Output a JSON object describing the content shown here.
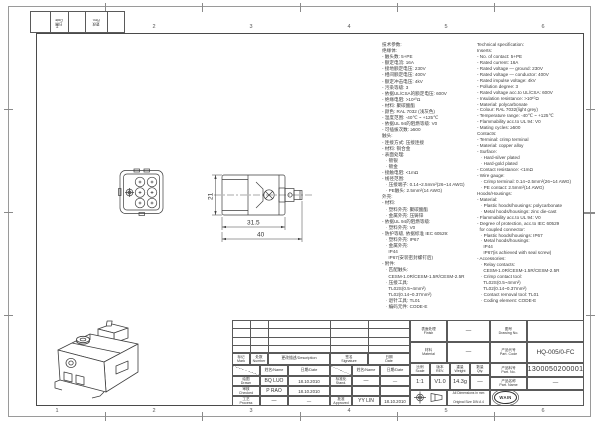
{
  "frame": {
    "zones": [
      "1",
      "2",
      "3",
      "4",
      "5",
      "6"
    ],
    "corner_date": "日期\nDate",
    "corner_rev": "更改\nRev."
  },
  "dims": {
    "height": "21",
    "width_inner": "31.5",
    "width_outer": "40"
  },
  "specs_cn": {
    "lines": [
      "技术参数:",
      "绝缘体:",
      "- 触头数: 5+PE",
      "- 额定电流: 16A",
      "- 接地额定电压: 230V",
      "- 相间额定电压: 400V",
      "- 额定冲击电压: 4kV",
      "- 污染等级: 3",
      "- 依据UL/CSA的额定电压: 600V",
      "- 绝缘电阻: >10¹⁰Ω",
      "- 材料: 聚碳酸酯",
      "- 颜色: RAL 7032 (浅灰色)",
      "- 温度范围: -40℃ ~ +125℃",
      "- 依据UL 94的阻燃等级: V0",
      "- 可插拔次数: ≥500",
      "触头:",
      "- 连接方式: 压接连接",
      "- 材料: 铜合金",
      "- 表面处理:",
      "   · 镀银",
      "   · 镀金",
      "- 接触电阻: <1mΩ",
      "- 线径范围:",
      "   · 压接端子: 0.14~2.5mm²(26~14 AWG)",
      "   · PE触头: 2.5mm²(14 AWG)",
      "外壳:",
      "- 材料:",
      "   · 塑料外壳: 聚碳酸酯",
      "   · 金属外壳: 压铸锌",
      "- 依据UL 94的阻燃等级:",
      "   · 塑料外壳: V0",
      "- 防护等级, 依据标准 IEC 60529:",
      "   · 塑料外壳: IP67",
      "   · 金属外壳:",
      "     IP44",
      "     IP67(安装密封螺钉后)",
      "- 附件:",
      "   · 匹配触头:",
      "     CESM-1.0R/CESM-1.5R/CESM-2.5R",
      "   · 压接工具:",
      "     TL02S(0.5~4mm²)",
      "     TL02(0.14~0.37mm²)",
      "   · 退针工具: TL01",
      "   · 编码元件: CODE-E"
    ]
  },
  "specs_en": {
    "lines": [
      "Technical specification:",
      "Inserts:",
      "- No. of contact: 5+PE",
      "- Rated current: 16A",
      "- Rated voltage — ground: 230V",
      "- Rated voltage — conductor: 400V",
      "- Rated impulse voltage: 4kV",
      "- Pollution degree: 3",
      "- Rated voltage acc.to UL/CSA: 600V",
      "- Insulation resistance: >10¹⁰Ω",
      "- Material: polycarbonate",
      "- Colour: RAL 7032(light grey)",
      "- Temperature range: -40℃ ~ +125℃",
      "- Flammability acc.to UL 94: V0",
      "- Mating cycles: ≥500",
      "Contacts:",
      "- Terminal: crimp terminal",
      "- Material: copper alloy",
      "- Surface:",
      "   · Hard-silver plated",
      "   · Hard-gold plated",
      "- Contact resistance: <1mΩ",
      "- Wire gauge:",
      "   · Crimp terminal: 0.14~2.5mm²(26~14 AWG)",
      "   · PE contact: 2.5mm²(14 AWG)",
      "Hoods/Housings:",
      "- Material:",
      "   · Plastic hoods/housings: polycarbonate",
      "   · Metal hoods/housings: zinc die-cast",
      "- Flammability acc.to UL 94: V0",
      "- Degree of protection, acc.to IEC 60529",
      "  for coupled connector:",
      "   · Plastic hoods/housings: IP67",
      "   · Metal hoods/housings:",
      "     IP44",
      "     IP67(is achieved with seal screw)",
      "- Accessories:",
      "   · Relay contacts:",
      "     CESM-1.0R/CESM-1.5R/CESM-2.5R",
      "   · Crimp contact tool:",
      "     TL02S(0.5~4mm²)",
      "     TL02(0.14~0.37mm²)",
      "   · Contact removal tool: TL01",
      "   · Coding element: CODE-E"
    ]
  },
  "titleblock": {
    "header": {
      "mark": "标记\nMark",
      "number": "处数\nNumber",
      "description": "更改描述/Description",
      "signature": "签名\nSignature",
      "date": "日期\nDate"
    },
    "subheader": {
      "name1": "姓名/Name",
      "date1": "日期/Date",
      "name2": "姓名/Name",
      "date2": "日期/Date"
    },
    "rows": [
      {
        "label": "绘图\nDrawn",
        "name": "BQ LUO",
        "date": "18.10.2010",
        "label2": "标准化\nStand.",
        "name2": "—",
        "date2": "—"
      },
      {
        "label": "审核\nChecked",
        "name": "P RAO",
        "date": "18.10.2010",
        "label2": "",
        "name2": "",
        "date2": ""
      },
      {
        "label": "工艺\nProcess",
        "name": "—",
        "date": "—",
        "label2": "批准\nApproved",
        "name2": "YY LIN",
        "date2": "18.10.2010"
      }
    ],
    "finish_label": "表面处理\nFinish",
    "finish_value": "—",
    "drawing_no_label": "图号\nDrawing No.",
    "drawing_no_value": "",
    "material_label": "材料\nMaterial",
    "material_value": "—",
    "part_code_label": "产品代号\nPart. Code",
    "part_code_value": "HQ-005/0-FC",
    "scale_label": "比例\nScale",
    "scale_value": "1:1",
    "rev_label": "版本\nREV.",
    "rev_value": "V1.0",
    "weight_label": "重量\nWeight",
    "weight_value": "14.3g",
    "qty_label": "数量\nQty.",
    "qty_value": "—",
    "part_no_label": "产品料号\nPart. No.",
    "part_no_value": "1300050200001",
    "part_name_label": "产品名称\nPart. Name",
    "part_name_value": "—",
    "note_line1": "All Dimensions in mm",
    "note_line2": "Original Size DIN A 4",
    "logo_text": "WAIN",
    "company_cn": "厦门唯恩电气有限公司",
    "company_en": "XIAMEN WAIN ELECTRICAL CO.LTD"
  }
}
